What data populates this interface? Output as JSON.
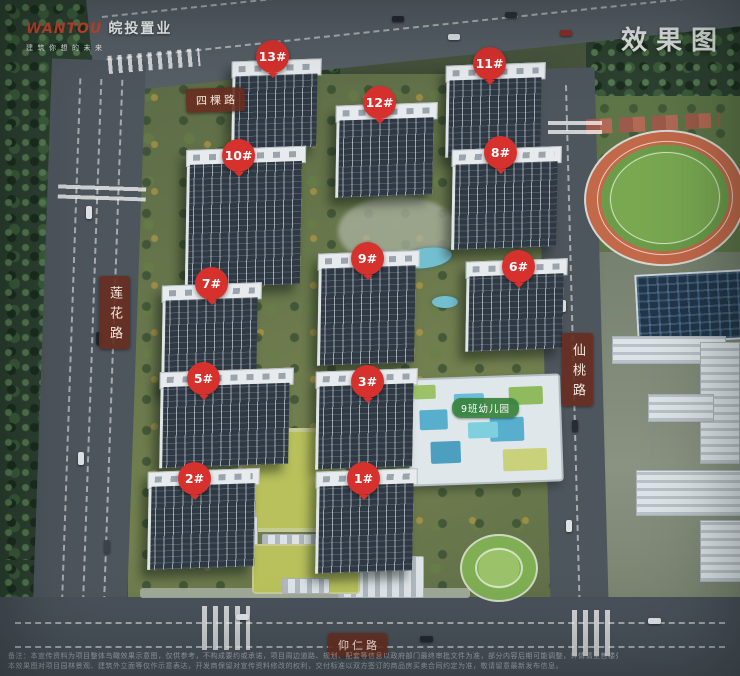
{
  "watermark": {
    "brand_en": "WANTOU",
    "brand_cn": "皖投置业",
    "tagline": "建筑你想的未来"
  },
  "corner_label": "效果图",
  "badges": [
    {
      "label": "13#"
    },
    {
      "label": "11#"
    },
    {
      "label": "12#"
    },
    {
      "label": "10#"
    },
    {
      "label": "8#"
    },
    {
      "label": "9#"
    },
    {
      "label": "6#"
    },
    {
      "label": "7#"
    },
    {
      "label": "5#"
    },
    {
      "label": "3#"
    },
    {
      "label": "2#"
    },
    {
      "label": "1#"
    }
  ],
  "roads": {
    "top": "四棵路",
    "left": "莲花路",
    "right": "仙桃路",
    "bottom": "仰仁路"
  },
  "poi": {
    "kindergarten": "9班幼儿园"
  },
  "colors": {
    "badge": "#d7312e",
    "road_label_bg": "rgba(104,46,32,0.9)",
    "poi_label_bg": "rgba(56,130,60,0.92)",
    "brand_red": "#c8432f",
    "corner_text": "rgba(248,250,250,0.95)"
  },
  "disclaimer": {
    "line1": "备注：本宣传资料为项目整体鸟瞰效果示意图，仅供参考，不构成要约或承诺，项目周边道路、规划、配套等信息以政府部门最终审批文件为准，部分内容后期可能调整，详情请至售楼处咨询。",
    "line2": "本效果图对项目园林景观、建筑外立面等仅作示意表达，开发商保留对宣传资料修改的权利，交付标准以双方签订的商品房买卖合同约定为准，敬请留意最新发布信息。"
  }
}
